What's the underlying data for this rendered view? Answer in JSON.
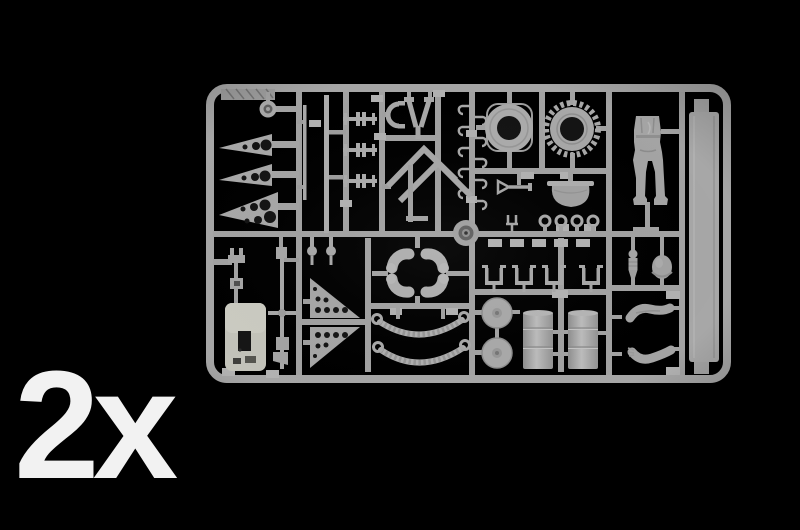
{
  "photo": {
    "subject": "plastic model kit sprue on black background",
    "quantity_label": "2x"
  },
  "colors": {
    "background": "#000000",
    "sprue_grey": "#a8a8a8",
    "runner_grey": "#a2a2a2",
    "frame_grey": "#a6a6a6",
    "sprue_light": "#b8b8b8",
    "sprue_dark": "#8e8e8e",
    "box_highlight": "#c3c3ba",
    "hole_black": "#141414",
    "label_text": "#f2f2f2"
  },
  "sprue": {
    "parts_visible": [
      "perforated cone gussets x4",
      "wheel hub",
      "long rods x2",
      "axle shafts x3",
      "c-bracket",
      "wishbone clevis",
      "nested angle brackets x2",
      "small hooks x9",
      "smooth tire",
      "tire retaining ring",
      "treaded tire",
      "key peg",
      "bowl",
      "fork bracket",
      "eyelets x4",
      "soldier lower body",
      "helmet",
      "stick grenade",
      "arms x2",
      "wooden plank",
      "funnel",
      "pintle clamp",
      "square nut",
      "storage box",
      "machine gun",
      "support posts x2",
      "perforated triangular plates x2",
      "fender horn segments x4",
      "tow cables x2",
      "u-brackets x4",
      "road wheels x2",
      "oil drums x2"
    ]
  }
}
